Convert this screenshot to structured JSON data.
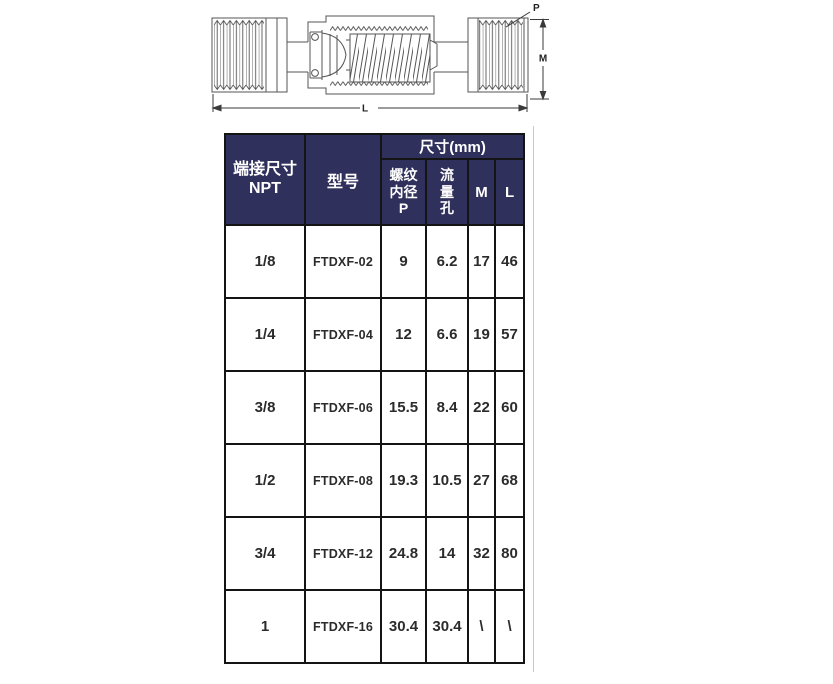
{
  "drawing": {
    "labels": {
      "p": "P",
      "m": "M",
      "l": "L"
    }
  },
  "table": {
    "header": {
      "npt_line1": "端接尺寸",
      "npt_line2": "NPT",
      "model": "型号",
      "size_group": "尺寸(mm)",
      "thread_lines": [
        "螺纹",
        "内径",
        "P"
      ],
      "flow_lines": [
        "流",
        "量",
        "孔"
      ],
      "m": "M",
      "l": "L"
    },
    "rows": [
      {
        "npt": "1/8",
        "model": "FTDXF-02",
        "thread_p": "9",
        "flow": "6.2",
        "m": "17",
        "l": "46"
      },
      {
        "npt": "1/4",
        "model": "FTDXF-04",
        "thread_p": "12",
        "flow": "6.6",
        "m": "19",
        "l": "57"
      },
      {
        "npt": "3/8",
        "model": "FTDXF-06",
        "thread_p": "15.5",
        "flow": "8.4",
        "m": "22",
        "l": "60"
      },
      {
        "npt": "1/2",
        "model": "FTDXF-08",
        "thread_p": "19.3",
        "flow": "10.5",
        "m": "27",
        "l": "68"
      },
      {
        "npt": "3/4",
        "model": "FTDXF-12",
        "thread_p": "24.8",
        "flow": "14",
        "m": "32",
        "l": "80"
      },
      {
        "npt": "1",
        "model": "FTDXF-16",
        "thread_p": "30.4",
        "flow": "30.4",
        "m": "\\",
        "l": "\\"
      }
    ]
  },
  "colors": {
    "header-bg": "#30305c",
    "header-text": "#ffffff",
    "border": "#141414",
    "body-text": "#2b2b2b",
    "line": "#555555"
  }
}
